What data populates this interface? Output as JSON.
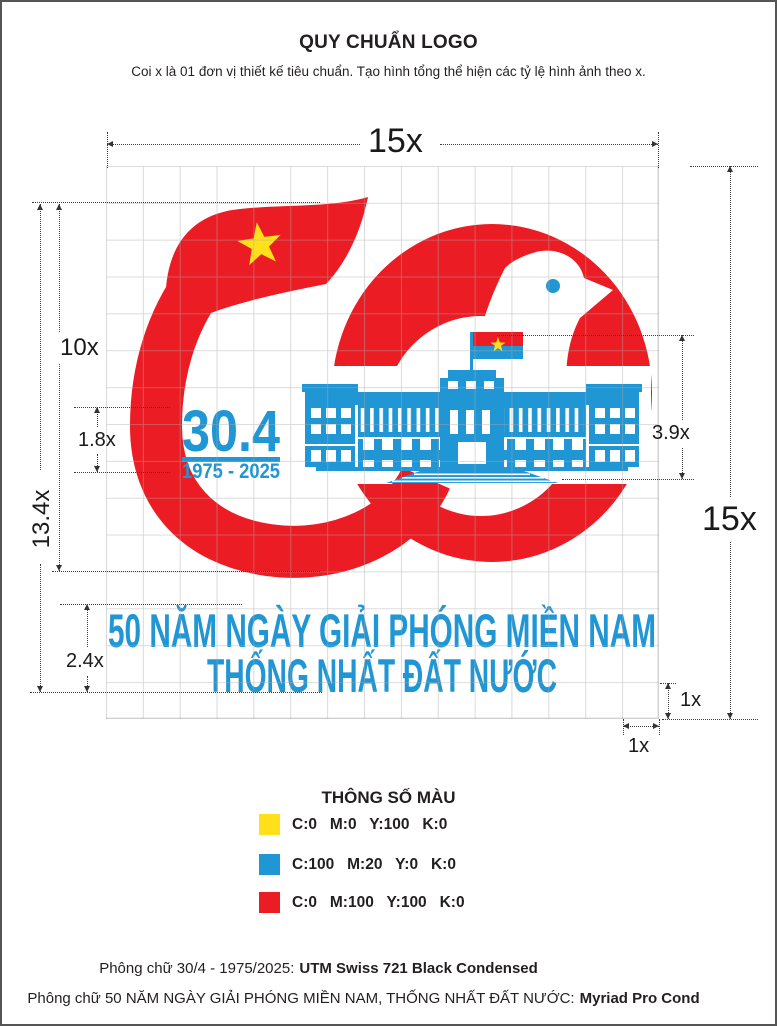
{
  "header": {
    "title": "QUY CHUẨN LOGO",
    "subtitle": "Coi x là 01 đơn vị thiết kế tiêu chuẩn. Tạo hình tổng thể hiện các tỷ lệ hình ảnh theo x."
  },
  "dimensions": {
    "grid_width": "15x",
    "grid_height": "15x",
    "logo_mark_height": "10x",
    "total_height": "13.4x",
    "date_block_height": "1.8x",
    "building_height": "3.9x",
    "slogan_block_height": "2.4x",
    "unit_cell_vertical": "1x",
    "unit_cell_horizontal": "1x"
  },
  "logo": {
    "date": "30.4",
    "years": "1975 - 2025",
    "slogan_line1": "50 NĂM NGÀY GIẢI PHÓNG MIỀN NAM",
    "slogan_line2": "THỐNG NHẤT ĐẤT NƯỚC"
  },
  "colors": {
    "red": "#EC1C24",
    "blue": "#2196D4",
    "yellow": "#FFDE17"
  },
  "legend": {
    "title": "THÔNG SỐ MÀU",
    "rows": [
      {
        "swatch": "#FFE01A",
        "cmyk": "C:0   M:0   Y:100   K:0"
      },
      {
        "swatch": "#2196D4",
        "cmyk": "C:100   M:20   Y:0   K:0"
      },
      {
        "swatch": "#EC1C24",
        "cmyk": "C:0   M:100   Y:100   K:0"
      }
    ]
  },
  "footer": {
    "line1_label": "Phông chữ 30/4 - 1975/2025:",
    "line1_font": "UTM Swiss 721 Black Condensed",
    "line2_label": "Phông chữ 50 NĂM NGÀY GIẢI PHÓNG MIỀN NAM, THỐNG NHẤT ĐẤT NƯỚC:",
    "line2_font": "Myriad Pro Cond"
  }
}
